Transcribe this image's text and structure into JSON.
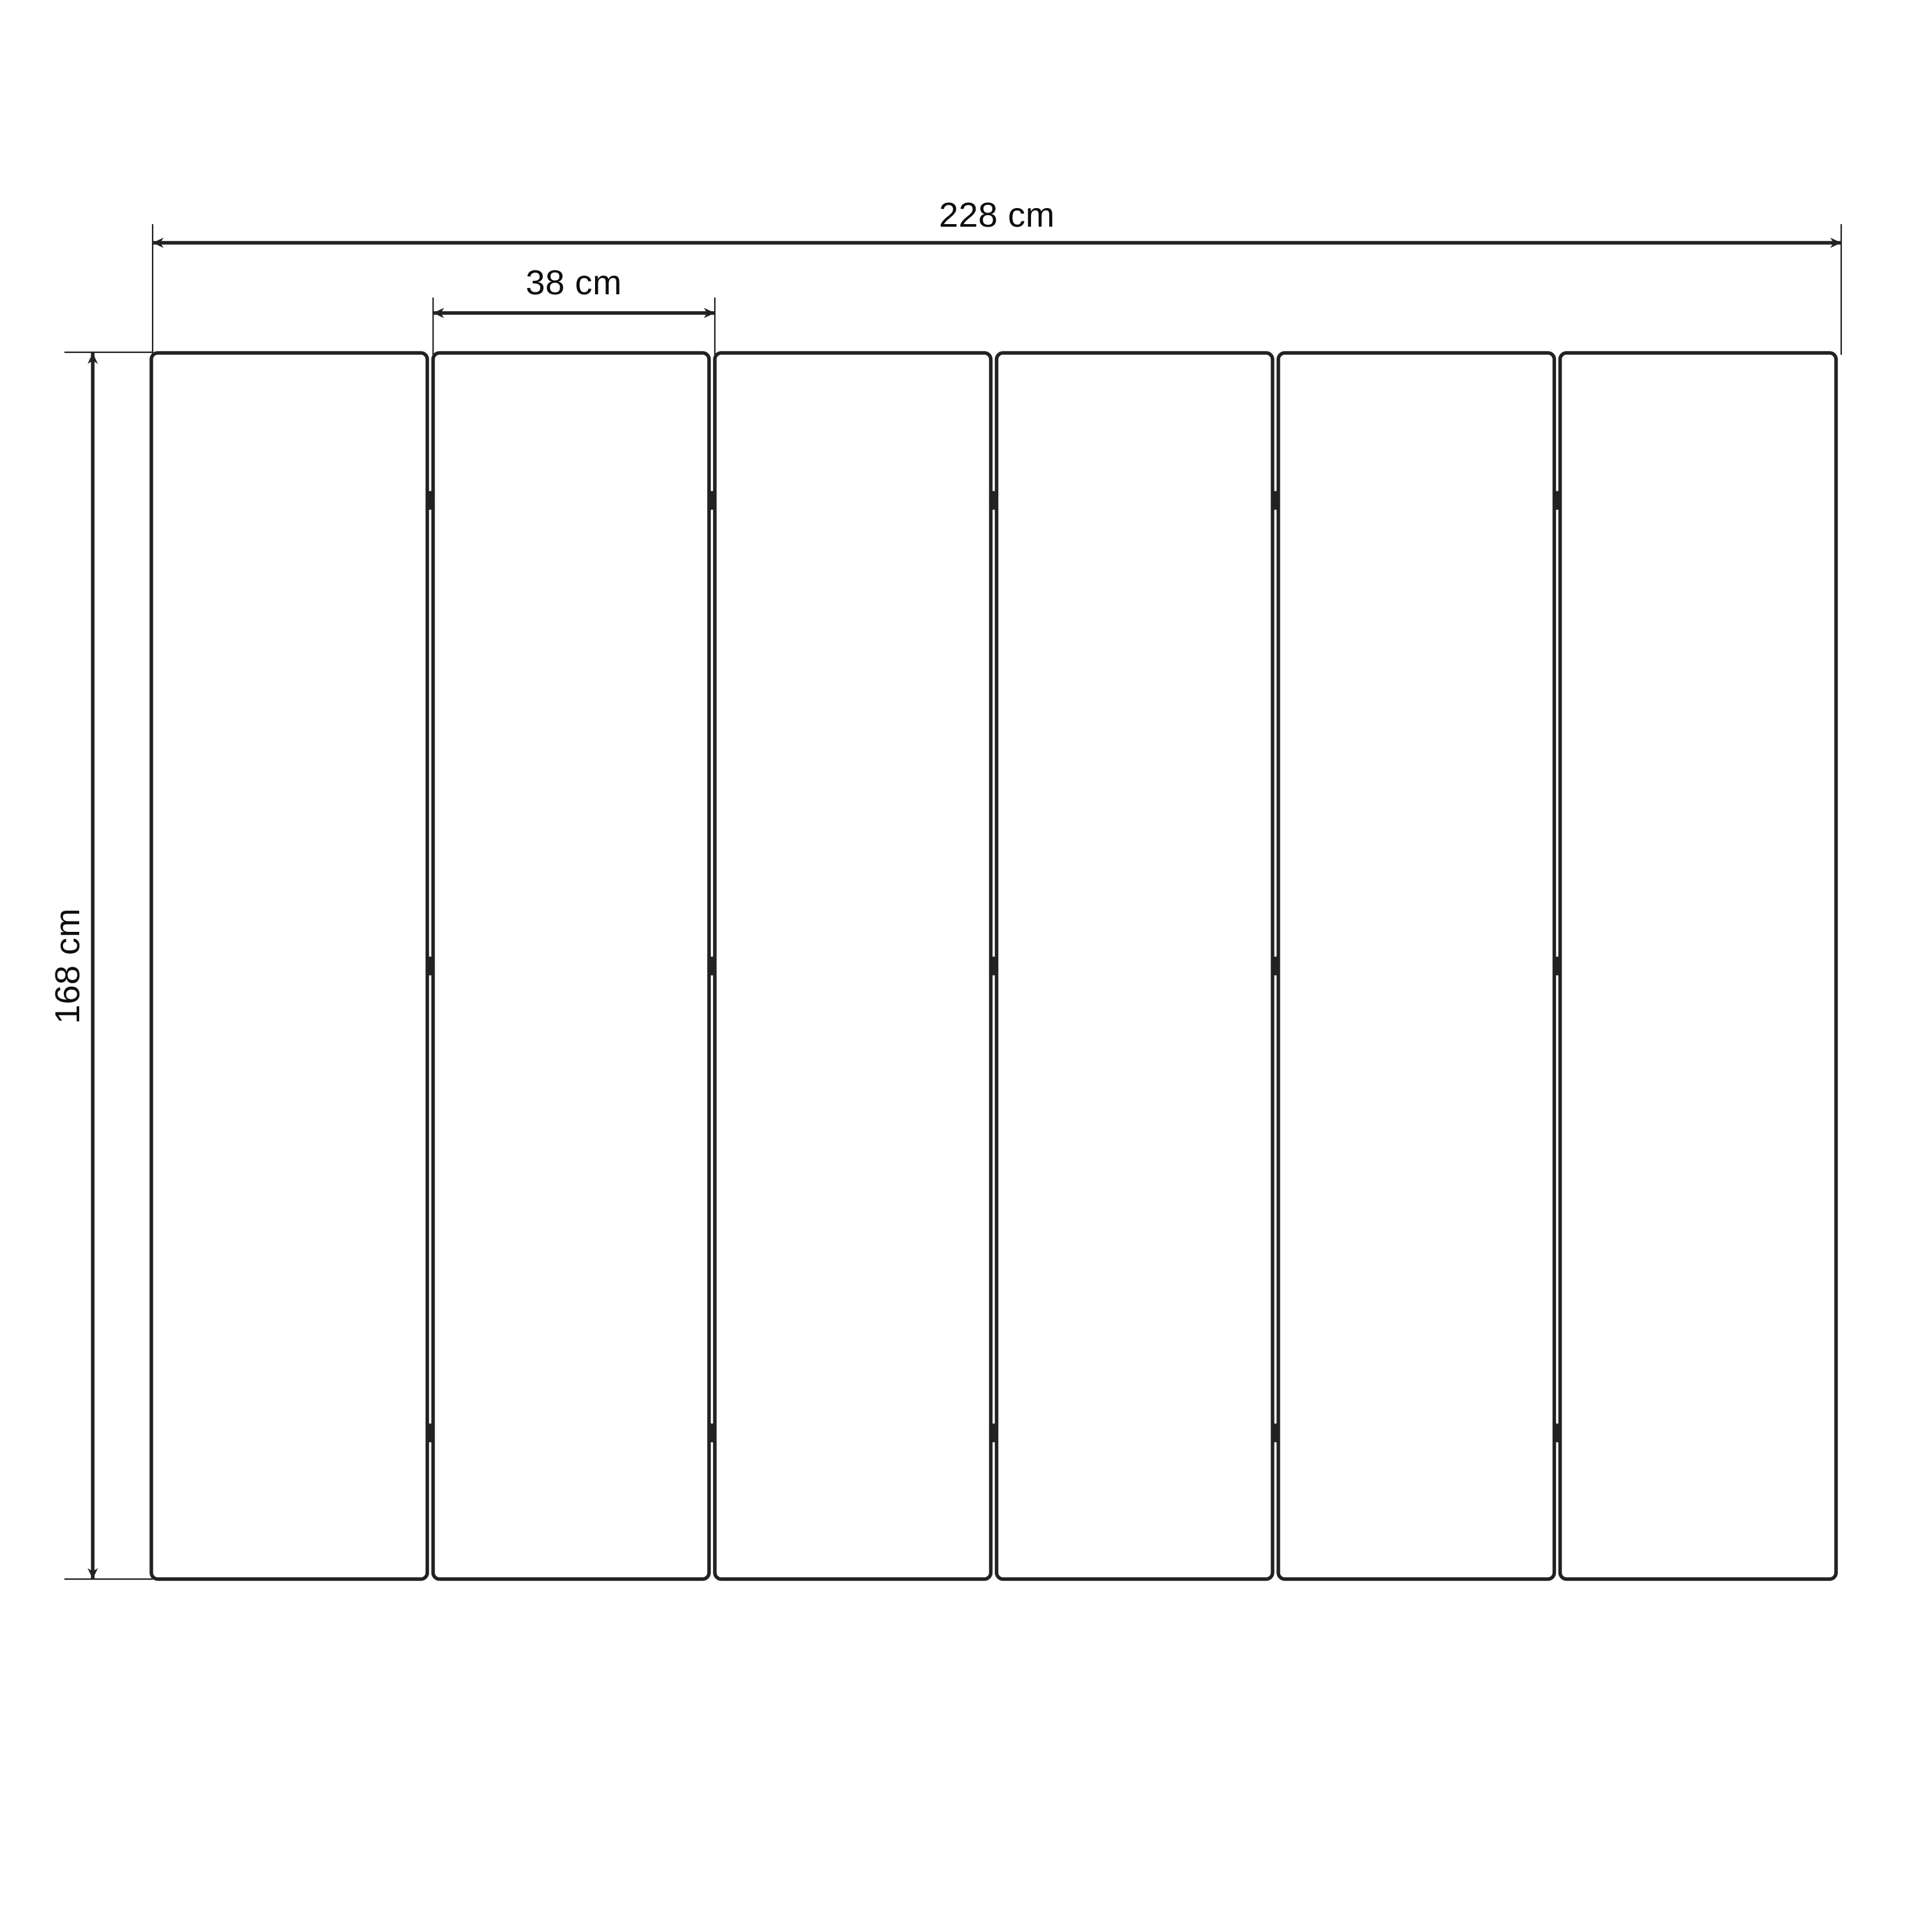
{
  "diagram": {
    "labels": {
      "total_width": "228 cm",
      "panel_width": "38 cm",
      "height": "168 cm"
    },
    "values": {
      "total_width_cm": 228,
      "panel_width_cm": 38,
      "height_cm": 168,
      "unit": "cm"
    },
    "panel_count": 6,
    "hinge_columns": 5,
    "hinge_rows": 3,
    "colors": {
      "background": "#ffffff",
      "panel_fill": "#ffffff",
      "line": "#222222",
      "text": "#0d0d0d"
    }
  }
}
